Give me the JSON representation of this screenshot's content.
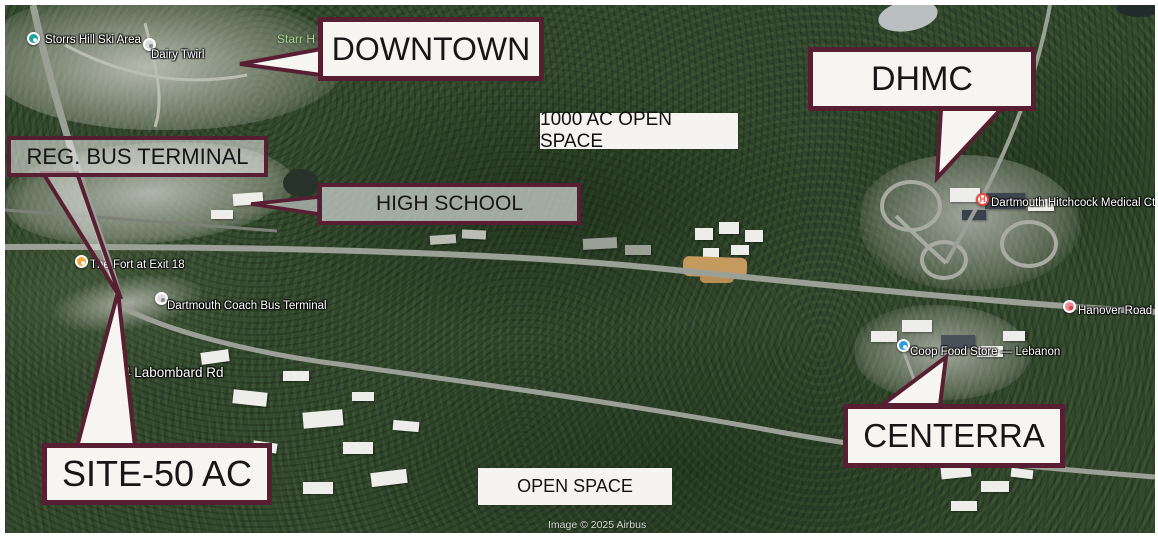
{
  "theme": {
    "callout_border": "#571f31",
    "callout_fill": "#f7f5f2"
  },
  "callouts": {
    "downtown": {
      "label": "DOWNTOWN"
    },
    "dhmc": {
      "label": "DHMC"
    },
    "reg_bus_terminal": {
      "label": "REG. BUS TERMINAL"
    },
    "high_school": {
      "label": "HIGH SCHOOL"
    },
    "site": {
      "label": "SITE-50 AC"
    },
    "centerra": {
      "label": "CENTERRA"
    }
  },
  "area_labels": {
    "open_space_1000": {
      "label": "1000 AC OPEN SPACE"
    },
    "open_space": {
      "label": "OPEN SPACE"
    }
  },
  "poi": {
    "storrs_hill": {
      "label": "Storrs Hill Ski Area",
      "pin_color": "#20a39a"
    },
    "dairy_twirl": {
      "label": "Dairy Twirl",
      "pin_color": "#dcdcdc"
    },
    "starr_hill": {
      "label": "Starr H",
      "text_color": "#a7d490"
    },
    "fort_exit_18": {
      "label": "The Fort at Exit 18",
      "pin_color": "#f0a73c"
    },
    "dartmouth_coach": {
      "label": "Dartmouth Coach  Bus Terminal",
      "pin_color": "#dcdcdc"
    },
    "labombard_rd": {
      "label": "4 Labombard Rd"
    },
    "dhmc_medical_ctr": {
      "label": "Dartmouth Hitchcock Medical Ctr",
      "pin_color": "#e8453c",
      "pin_glyph": "H"
    },
    "hanover_road": {
      "label": "Hanover Road",
      "pin_color": "#ef8a93"
    },
    "coop_food_store": {
      "label": "Coop Food Store — Lebanon",
      "pin_color": "#2e9bdb"
    }
  },
  "watermark": {
    "label": "Image © 2025 Airbus"
  }
}
